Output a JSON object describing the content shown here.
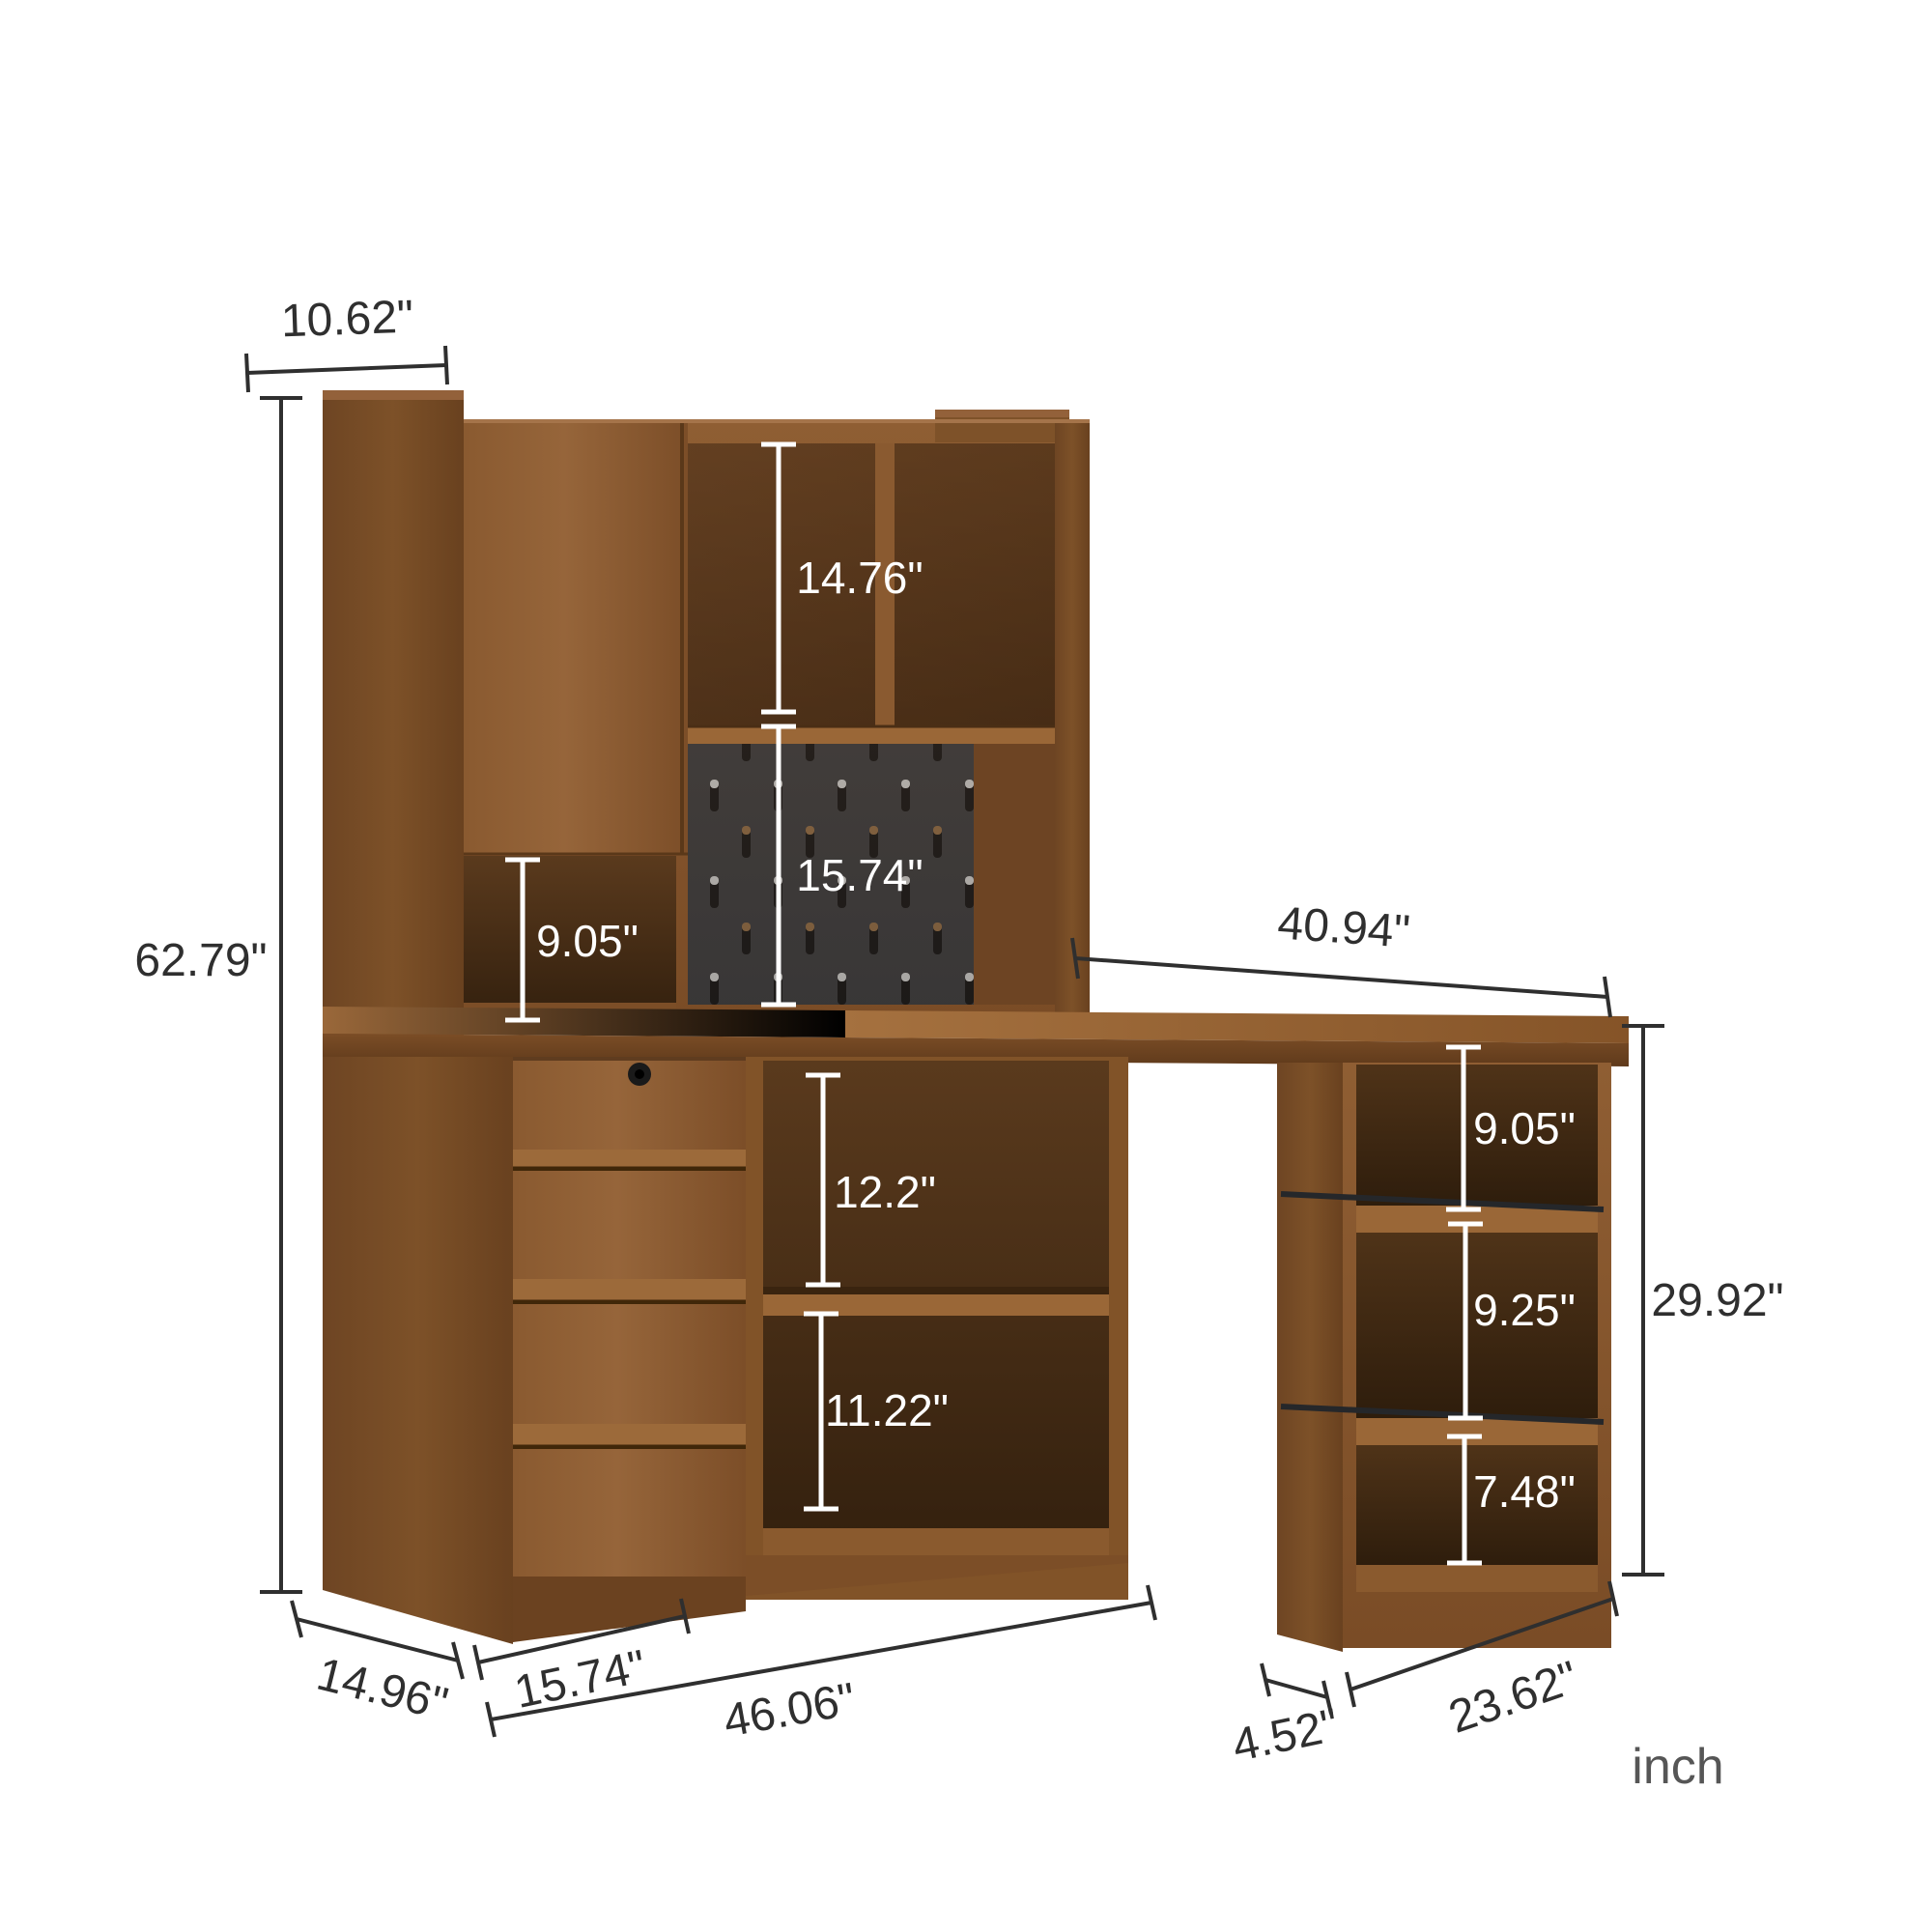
{
  "title": "corner-desk-with-hutch-dimension-diagram",
  "unit": {
    "label": "inch"
  },
  "dims": {
    "top_width": "10.62\"",
    "total_height": "62.79\"",
    "hutch_shelf_height": "14.76\"",
    "pegboard_height": "15.74\"",
    "cubby_height": "9.05\"",
    "desktop_width": "40.94\"",
    "underdesk_upper_shelf_height": "12.2\"",
    "underdesk_lower_shelf_height": "11.22\"",
    "right_shelf_top_height": "9.05\"",
    "right_shelf_middle_height": "9.25\"",
    "right_shelf_bottom_height": "7.48\"",
    "right_unit_height": "29.92\"",
    "cabinet_depth": "14.96\"",
    "drawer_unit_width": "15.74\"",
    "left_unit_width": "46.06\"",
    "knee_space_offset": "4.52\"",
    "right_unit_width": "23.62\""
  },
  "colors": {
    "wood_mid": "#8a5a30",
    "wood_dark_side": "#6b4220",
    "wood_light_top": "#a06c3c",
    "interior_dark": "#33200e",
    "pegboard": "#3a3d42",
    "metal_rail": "#25272a",
    "dimension_dark": "#2f2f2f",
    "dimension_light": "#ffffff",
    "unit_text": "#565656"
  }
}
